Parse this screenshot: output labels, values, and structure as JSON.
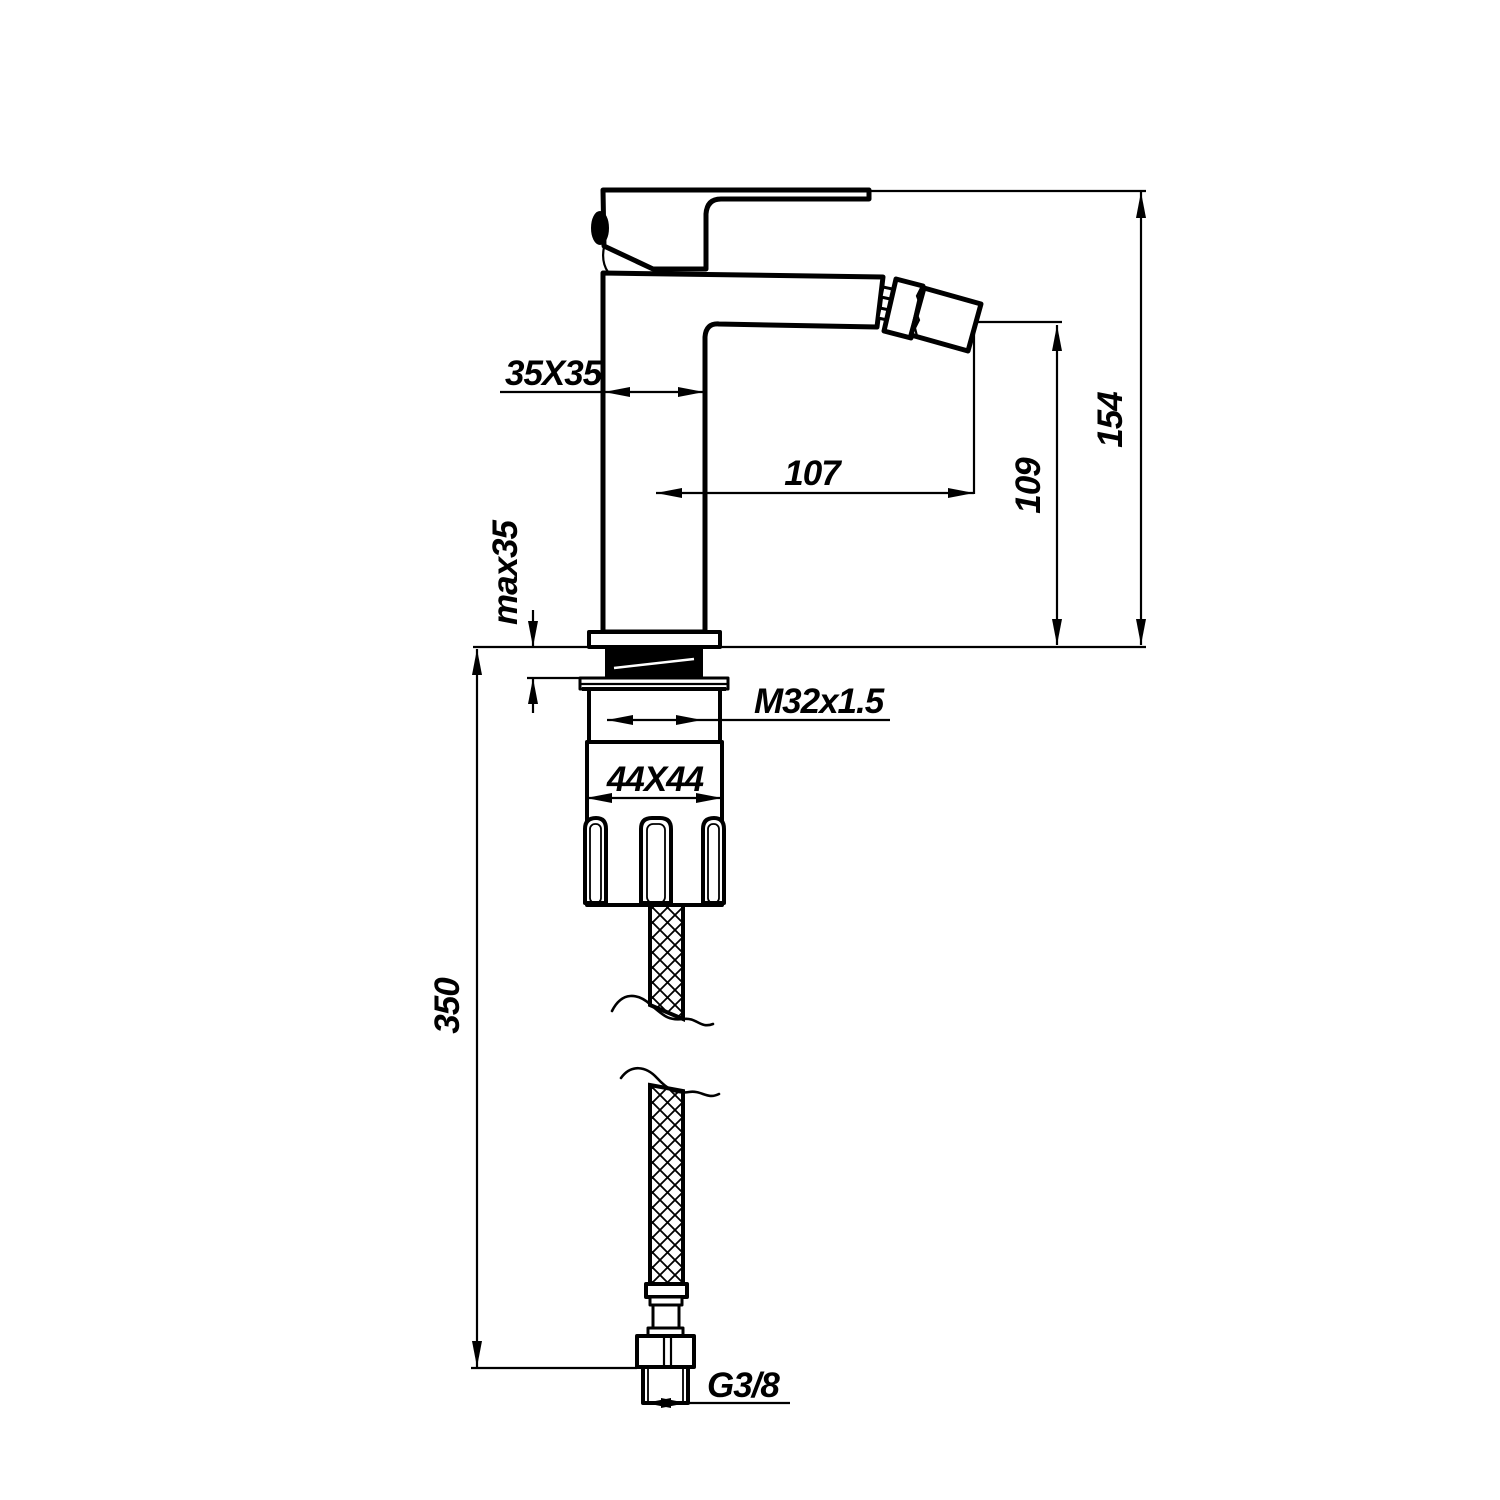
{
  "drawing": {
    "subject": "single-lever bidet mixer tap - side elevation dimension drawing with flexible supply hose",
    "background_color": "#ffffff",
    "line_color": "#000000",
    "dimensions": {
      "body_section": "35X35",
      "spout_reach": "107",
      "spout_outlet_height": "109",
      "overall_height": "154",
      "max_mounting_thickness": "max35",
      "shank_thread": "M32x1.5",
      "base_nut_section": "44X44",
      "hose_length": "350",
      "hose_connection_thread": "G3/8"
    }
  }
}
